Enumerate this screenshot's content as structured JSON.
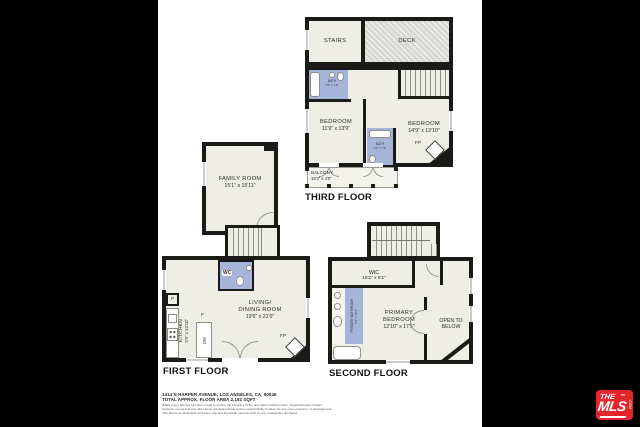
{
  "colors": {
    "wall": "#1a1a17",
    "floor": "#efeee6",
    "bath_blue": "#a7b4da",
    "deck_gray": "#d8d7d2",
    "logo_red": "#e4252b",
    "background": "#000000",
    "sheet": "#ffffff"
  },
  "third_floor": {
    "title": "THIRD FLOOR",
    "stairs_label": "STAIRS",
    "deck_label": "DECK",
    "bath_name": "BATH",
    "bath_dims": "7'5\" x 4'5\"",
    "bedroom1_name": "BEDROOM",
    "bedroom1_dims": "11'9\" x 13'9\"",
    "bedroom2_name": "BEDROOM",
    "bedroom2_dims": "14'9\" x 13'10\"",
    "bath2_name": "BATH",
    "bath2_dims": "4'0\" x 7'5\"",
    "balcony_name": "BALCONY",
    "balcony_dims": "18'2\" x 4'0\"",
    "fireplace_label": "FP"
  },
  "first_floor": {
    "title": "FIRST FLOOR",
    "family_room_name": "FAMILY ROOM",
    "family_room_dims": "15'1\" x 15'11\"",
    "living_name_line1": "LIVING/",
    "living_name_line2": "DINING ROOM",
    "living_dims": "19'6\" x 21'0\"",
    "kitchen_name": "KITCHEN",
    "kitchen_dims": "9'9\" x 13'10\"",
    "wc_label": "WC",
    "dw_label": "DW",
    "pantry_label": "P",
    "fireplace_label": "FP"
  },
  "second_floor": {
    "title": "SECOND FLOOR",
    "wic_name": "WIC",
    "wic_dims": "16'2\" x 5'1\"",
    "primary_bath_name": "PRIMARY BATHROOM",
    "primary_bath_dims": "5'3\" x 10'3\"",
    "primary_bedroom_line1": "PRIMARY",
    "primary_bedroom_line2": "BEDROOM",
    "primary_bedroom_dims": "12'10\" x 17'5\"",
    "open_to_below_line1": "OPEN TO",
    "open_to_below_line2": "BELOW"
  },
  "footer": {
    "address": "1414 N HARPER AVENUE, LOS ANGELES, CA, 90046",
    "area": "TOTAL APPROX. FLOOR AREA 2,192 SQFT",
    "disclaimer_line1": "Whilst every attempt has been made to ensure the accuracy of the floor plan contained here, measurements of doors,",
    "disclaimer_line2": "windows, rooms and any other items are approximate and no responsibility is taken for any error, omission, or misstatement.",
    "disclaimer_line3": "This plan is for illustrative purposes only and should be used as such by any prospective purchaser."
  },
  "logo": {
    "the": "THE",
    "mls": "MLS",
    "tm": "TM",
    "com": ".COM"
  }
}
